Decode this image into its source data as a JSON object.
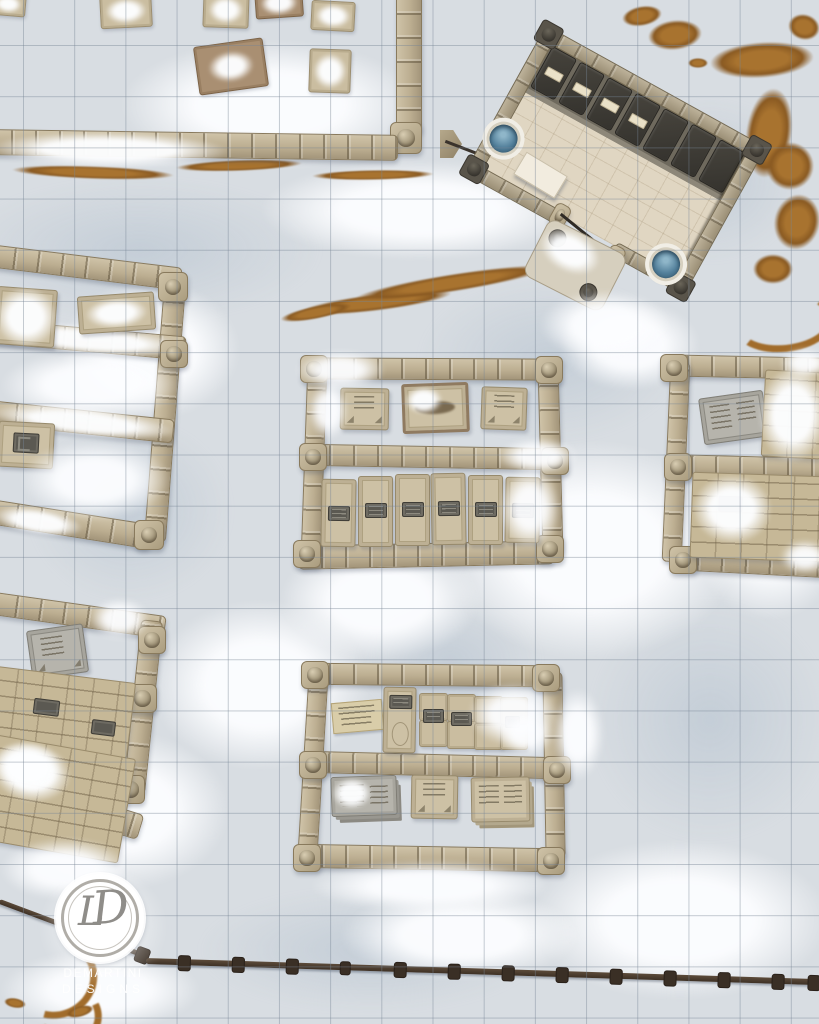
{
  "watermark": {
    "monogram_l": "L",
    "monogram_d": "D",
    "line1": "DEMARTINI",
    "line2": "DESIGNS"
  },
  "map": {
    "type": "top-down snowy battle map",
    "setting": "snow-covered graveyard market with stone-walled pens, a roadside stone building and a wooden rail fence",
    "grid": {
      "cell_size_px": 51,
      "columns": 16,
      "rows": 20,
      "line_color": "#7684a8"
    },
    "palette": {
      "ground_snow": "#d8dde2",
      "snow_white": "#f4f7f9",
      "stone_wall": "#bcae91",
      "stone_edge": "#897a5d",
      "grave_tan": "#cdc1a5",
      "slab_grey": "#b6b4ac",
      "plaque_dark": "#5b5952",
      "building_floor": "#e0d6c2",
      "stall_dark": "#3b3832",
      "water_blue": "#527f9a",
      "mud_brown": "#a8732f",
      "fence_brown": "#4a3b2d"
    },
    "features": {
      "building": {
        "label": "rotated stone building with stall row",
        "stall_cells": 7,
        "bedded_stalls": 4,
        "basins": 2,
        "tables": 1,
        "entrance": "chain-gated gap with stone porch"
      },
      "pens": [
        {
          "id": "north-pen",
          "label": "open yard with scattered snowy crates",
          "crates": 7
        },
        {
          "id": "west-pen",
          "label": "snow-buried walled pen",
          "graves": 3
        },
        {
          "id": "center-pen",
          "label": "double pen with marker slabs and grave slabs",
          "marker_slabs": 3,
          "grave_slabs": 6
        },
        {
          "id": "east-pen",
          "label": "double pen with grey marker and brick platforms",
          "marker_slabs": 1,
          "brick_platforms": 2
        },
        {
          "id": "south-center-pen",
          "label": "double pen with crates, sign and tablets",
          "tablets": 3,
          "crates": 8,
          "signs": 1
        },
        {
          "id": "south-west-pen",
          "label": "pen with grey marker and brick platforms",
          "marker_slabs": 1,
          "brick_platforms": 2
        }
      ],
      "fence": {
        "label": "wooden rail fence along bottom",
        "posts": 14
      }
    }
  }
}
